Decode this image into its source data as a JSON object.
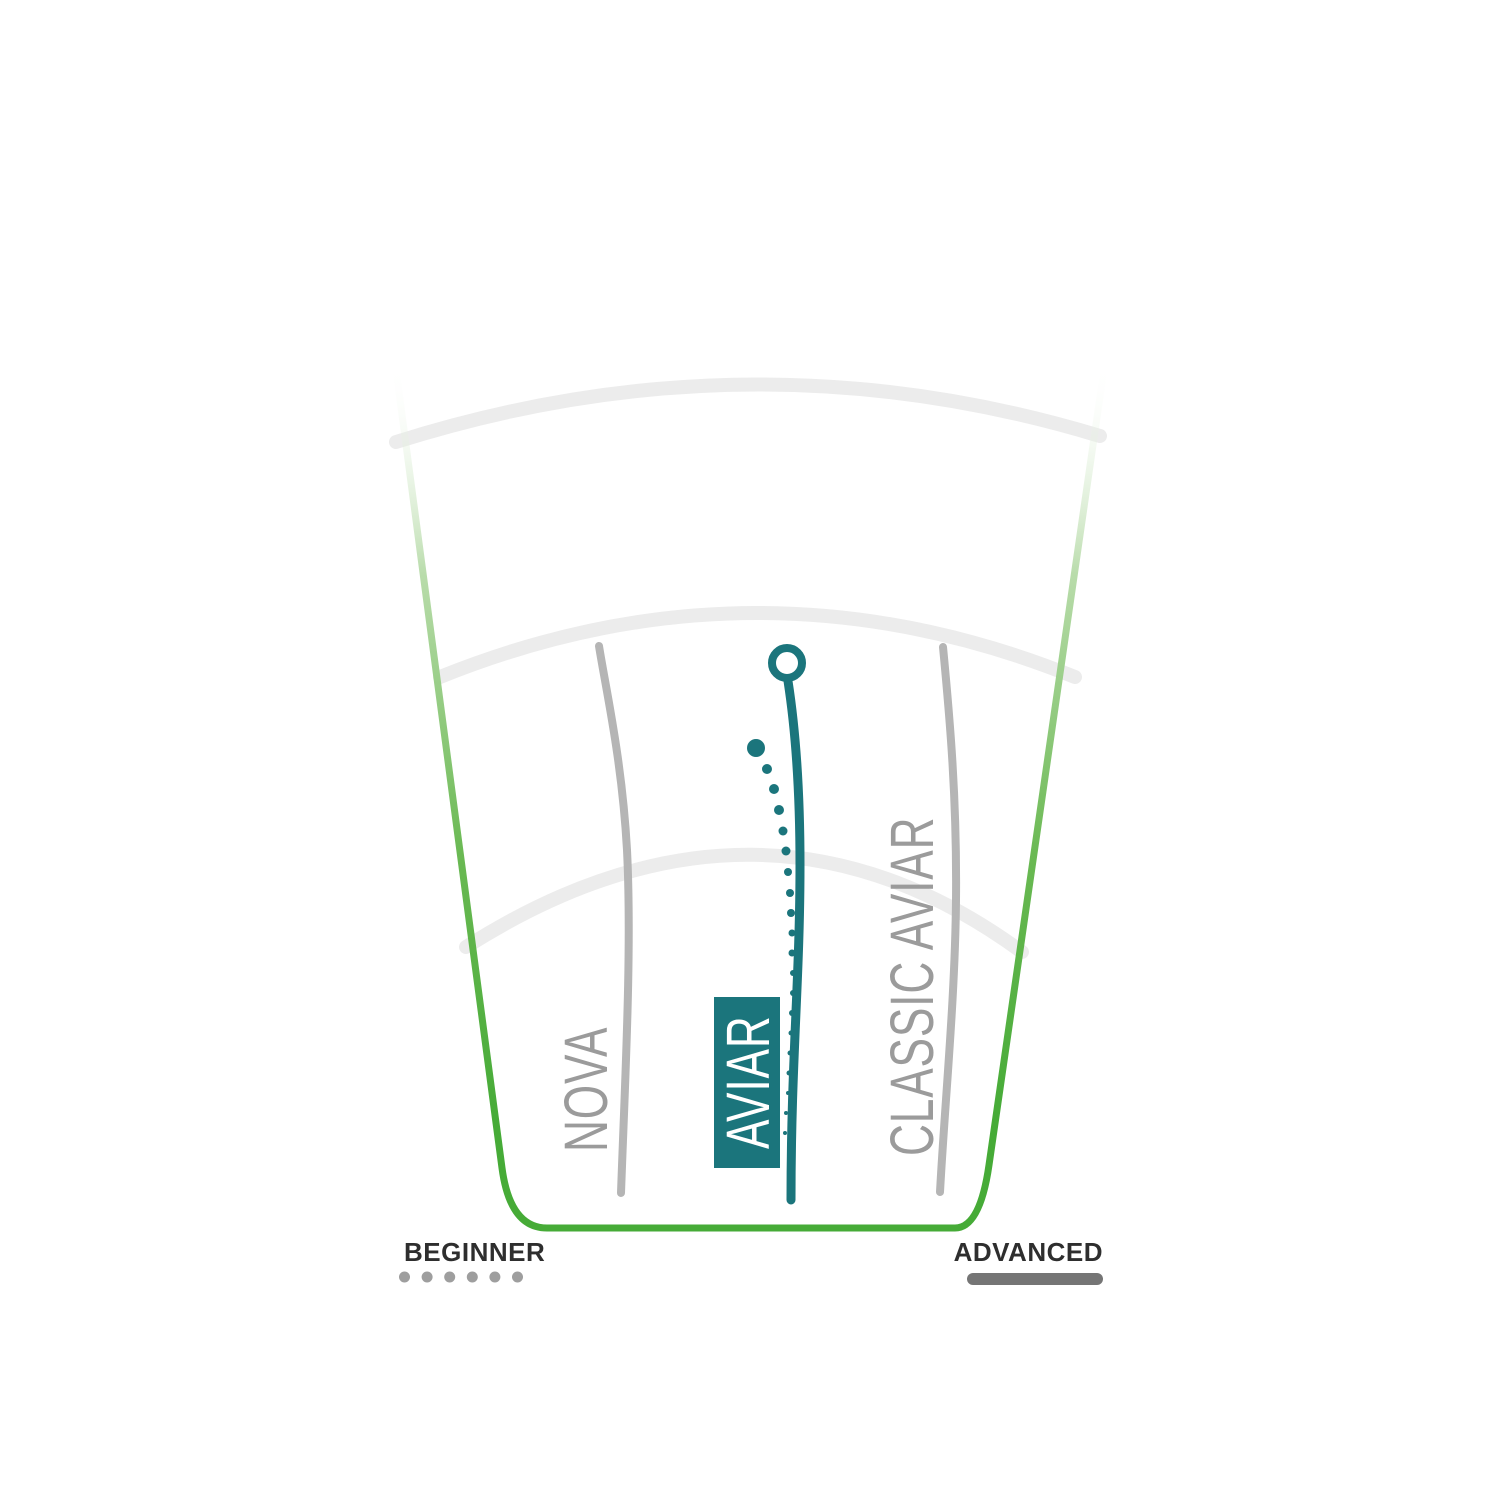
{
  "colors": {
    "fairway_green": "#46ab37",
    "fairway_green_mid": "#6ab953",
    "fairway_green_faded": "#b9dcab",
    "flight_teal": "#1b757c",
    "guide_arc_gray": "#ececec",
    "flight_line_gray": "#b5b5b5",
    "label_gray": "#9b9b9b",
    "legend_text_dark": "#2e2e2e",
    "beginner_dots_gray": "#9e9e9e",
    "advanced_bar_gray": "#757575",
    "background": "#ffffff"
  },
  "discs": [
    {
      "label": "NOVA",
      "highlighted": false,
      "line_style": "solid-gray"
    },
    {
      "label": "AVIAR",
      "highlighted": true,
      "line_style": "solid-teal-with-fade-dots"
    },
    {
      "label": "CLASSIC AVIAR",
      "highlighted": false,
      "line_style": "solid-gray"
    }
  ],
  "legend": {
    "beginner_label": "BEGINNER",
    "advanced_label": "ADVANCED",
    "beginner_dot_count": 6,
    "beginner_marker": "dotted-line",
    "advanced_marker": "solid-line"
  },
  "diagram": {
    "description": "Disc golf putter flight paths on a fairway fan from BEGINNER (left) to ADVANCED (right)",
    "fairway_outline": "M 395 362 L 502 1168 Q 510 1228 547 1228 L 955 1228 Q 980 1228 989 1165 L 1105 362",
    "range_arcs": [
      "M 396 442 Q 750 330 1100 436",
      "M 440 677 Q 757 549 1075 677",
      "M 466 947 Q 760 760 1022 952"
    ],
    "nova_path": "M 599 646 C 606 690 622 760 627 850 C 632 950 625 1080 621 1193",
    "classic_aviar_path": "M 943 647 C 950 720 957 800 956 900 C 955 1000 945 1100 940 1192",
    "aviar_path": "M 788 681 C 794 720 800 780 800 865 C 800 980 791 1060 791 1200",
    "aviar_start_circle": {
      "cx": 787,
      "cy": 663,
      "r": 15
    },
    "aviar_fade_dots": [
      [
        756,
        748,
        9
      ],
      [
        767,
        769,
        5
      ],
      [
        774,
        789,
        5
      ],
      [
        779,
        810,
        5
      ],
      [
        783,
        831,
        4.5
      ],
      [
        786,
        851,
        4.5
      ],
      [
        788,
        872,
        4
      ],
      [
        790,
        893,
        4
      ],
      [
        791,
        913,
        4
      ],
      [
        792,
        933,
        3.5
      ],
      [
        792,
        953,
        3.5
      ],
      [
        793,
        973,
        3
      ],
      [
        793,
        993,
        3
      ],
      [
        792,
        1013,
        3
      ],
      [
        791,
        1033,
        2.5
      ],
      [
        790,
        1053,
        2.5
      ],
      [
        789,
        1073,
        2.5
      ],
      [
        788,
        1093,
        2
      ],
      [
        786,
        1113,
        2
      ],
      [
        785,
        1133,
        2
      ]
    ],
    "beginner_dots": {
      "start_x": 404.5,
      "y": 1277,
      "spacing": 22.6,
      "radius": 5.5
    }
  }
}
